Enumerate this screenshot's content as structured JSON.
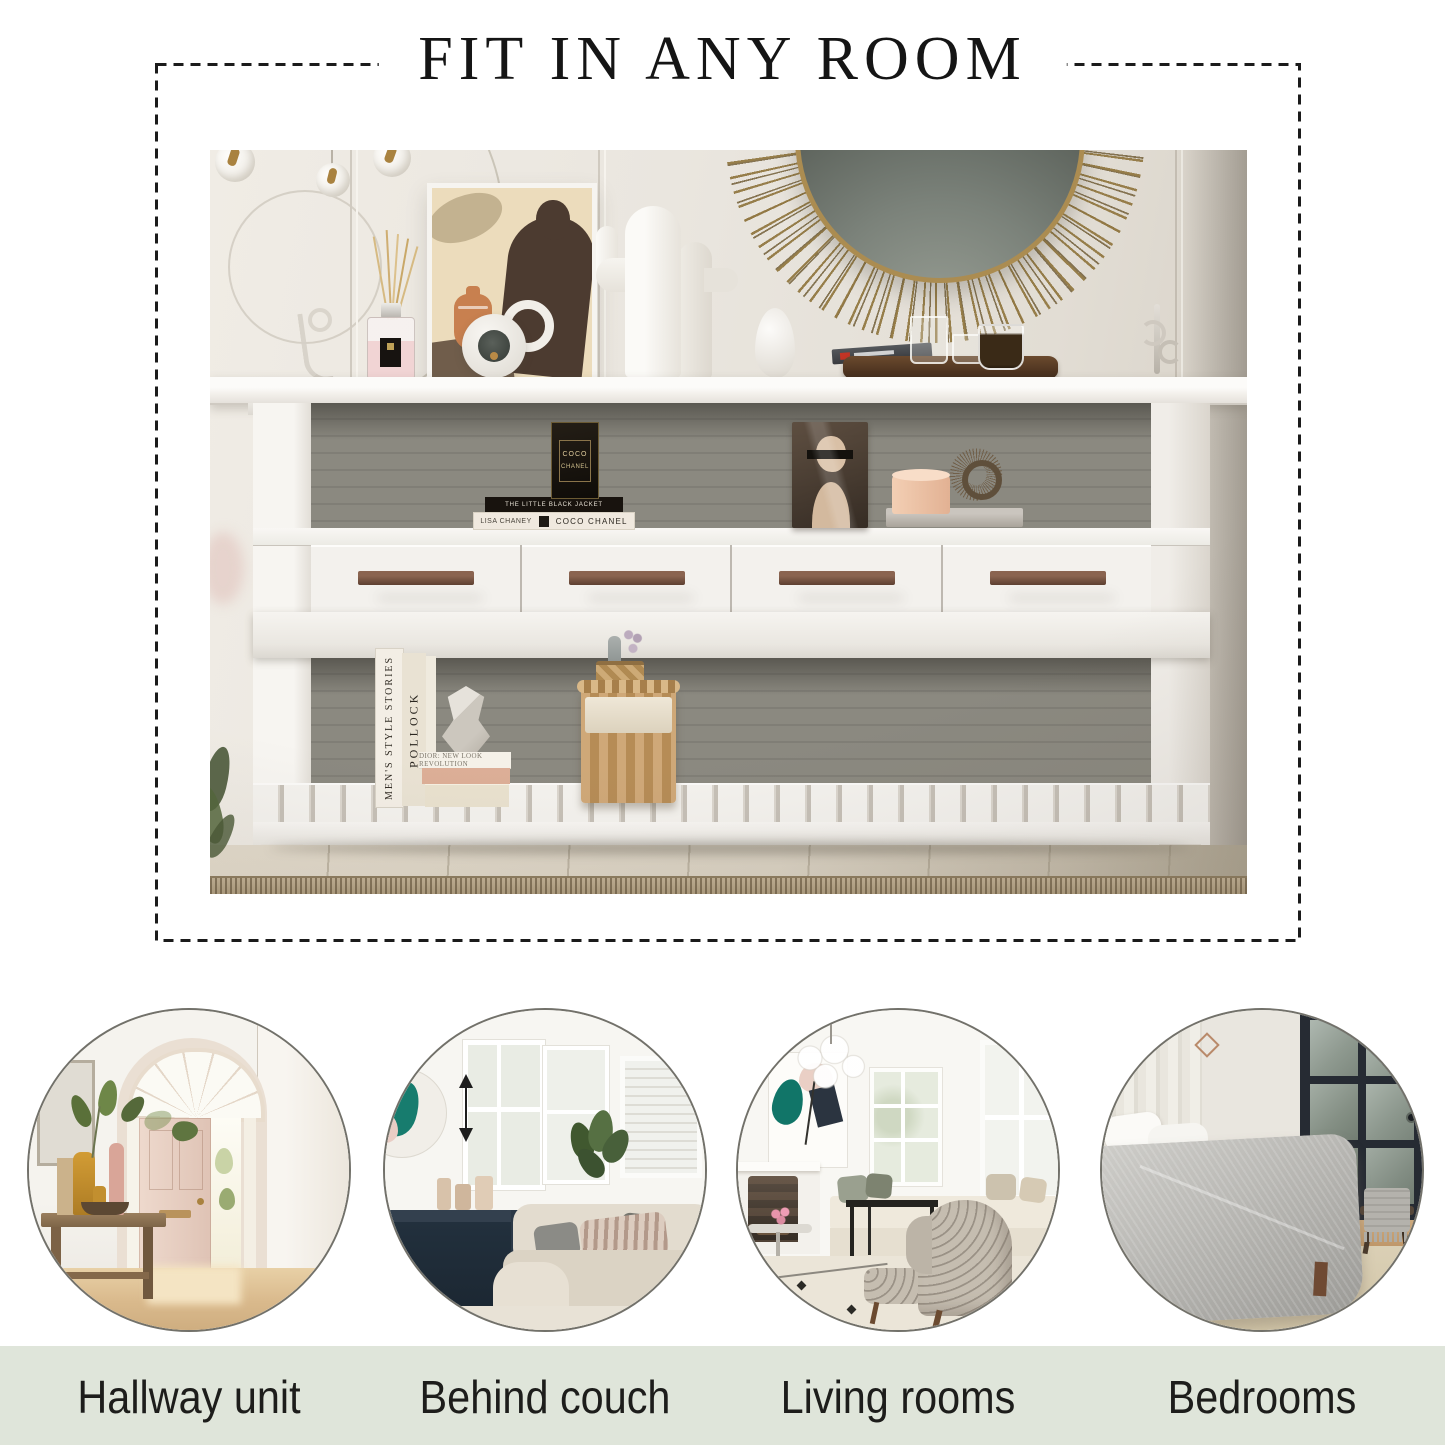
{
  "title": "FIT IN ANY ROOM",
  "rooms": [
    {
      "label": "Hallway unit"
    },
    {
      "label": "Behind couch"
    },
    {
      "label": "Living rooms"
    },
    {
      "label": "Bedrooms"
    }
  ],
  "hero": {
    "decor": {
      "perfume_box_line1": "COCO",
      "perfume_box_line2": "CHANEL",
      "book_black_spine": "THE LITTLE BLACK JACKET",
      "book_white_author": "LISA CHANEY",
      "book_white_title": "COCO CHANEL",
      "book_standing_1": "MEN'S STYLE STORIES",
      "book_standing_2": "POLLOCK",
      "book_stacked_top": "DIOR: NEW LOOK REVOLUTION"
    }
  },
  "colors": {
    "accent_bar": "#dfe5da",
    "dash_border": "#1b1b1b",
    "label_text": "#1d1d1b",
    "drawer_handle": "#6b4a38"
  }
}
